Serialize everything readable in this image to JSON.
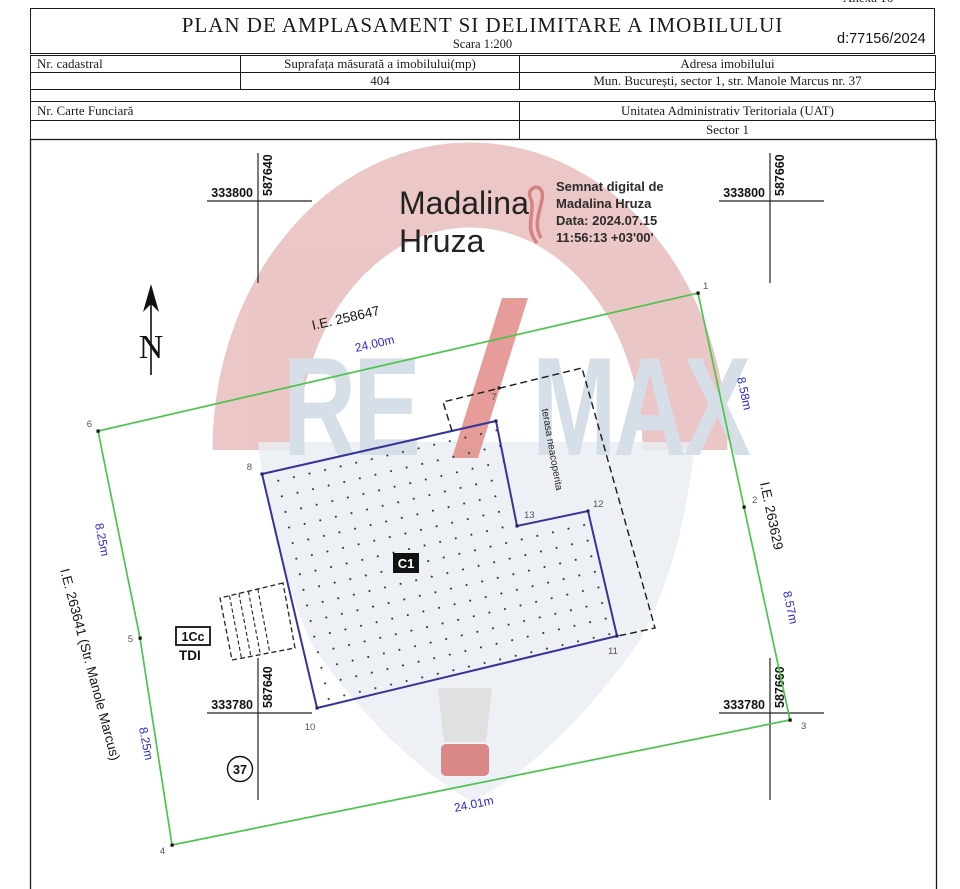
{
  "page": {
    "annex_note": "Anexa 16",
    "title": "PLAN DE AMPLASAMENT SI DELIMITARE A IMOBILULUI",
    "scale": "Scara 1:200",
    "doc_number": "d:77156/2024"
  },
  "info_table": {
    "headers": [
      "Nr. cadastral",
      "Suprafața măsurată a imobilului(mp)",
      "Adresa imobilului"
    ],
    "values": [
      "",
      "404",
      "Mun. București, sector 1, str. Manole Marcus nr. 37"
    ]
  },
  "secondary_table": {
    "left_header": "Nr. Carte Funciară",
    "right_header": "Unitatea Administrativ Teritoriala (UAT)",
    "left_value": "",
    "right_value": "Sector 1"
  },
  "signature": {
    "name_line1": "Madalina",
    "name_line2": "Hruza",
    "details": [
      "Semnat digital de",
      "Madalina Hruza",
      "Data: 2024.07.15",
      "11:56:13 +03'00'"
    ]
  },
  "watermark": {
    "part1": "RE",
    "part2": "MAX"
  },
  "compass": {
    "label": "N"
  },
  "crosses": {
    "tl": {
      "x": "333800",
      "y": "587640"
    },
    "tr": {
      "x": "333800",
      "y": "587660"
    },
    "bl": {
      "x": "333780",
      "y": "587640"
    },
    "br": {
      "x": "333780",
      "y": "587660"
    }
  },
  "parcel": {
    "ie_top": "I.E. 258647",
    "len_top": "24.00m",
    "len_right_upper": "8.58m",
    "ie_right": "I.E. 263629",
    "len_right_lower": "8.57m",
    "len_left_upper": "8.25m",
    "ie_left": "I.E. 263641 (Str. Manole Marcus)",
    "len_left_lower": "8.25m",
    "len_bottom": "24.01m",
    "street_number": "37",
    "points": {
      "p1": "1",
      "p2": "2",
      "p3": "3",
      "p4": "4",
      "p5": "5",
      "p6": "6"
    }
  },
  "building": {
    "label": "C1",
    "terrace_label": "terasa neacoperita",
    "annex_label": "1Cc",
    "annex_sub_label": "TDI",
    "points": {
      "p7": "7",
      "p8": "8",
      "p10": "10",
      "p11": "11",
      "p12": "12",
      "p13": "13"
    }
  },
  "colors": {
    "boundary_green": "#4cc44c",
    "building_blue": "#34349a",
    "dimension_blue": "#2a2ace",
    "ink_black": "#1a1a1a",
    "watermark_red": "#e7b9b9",
    "watermark_gray_blue": "#ccd6e2",
    "watermark_basket_red": "#cc5252"
  }
}
